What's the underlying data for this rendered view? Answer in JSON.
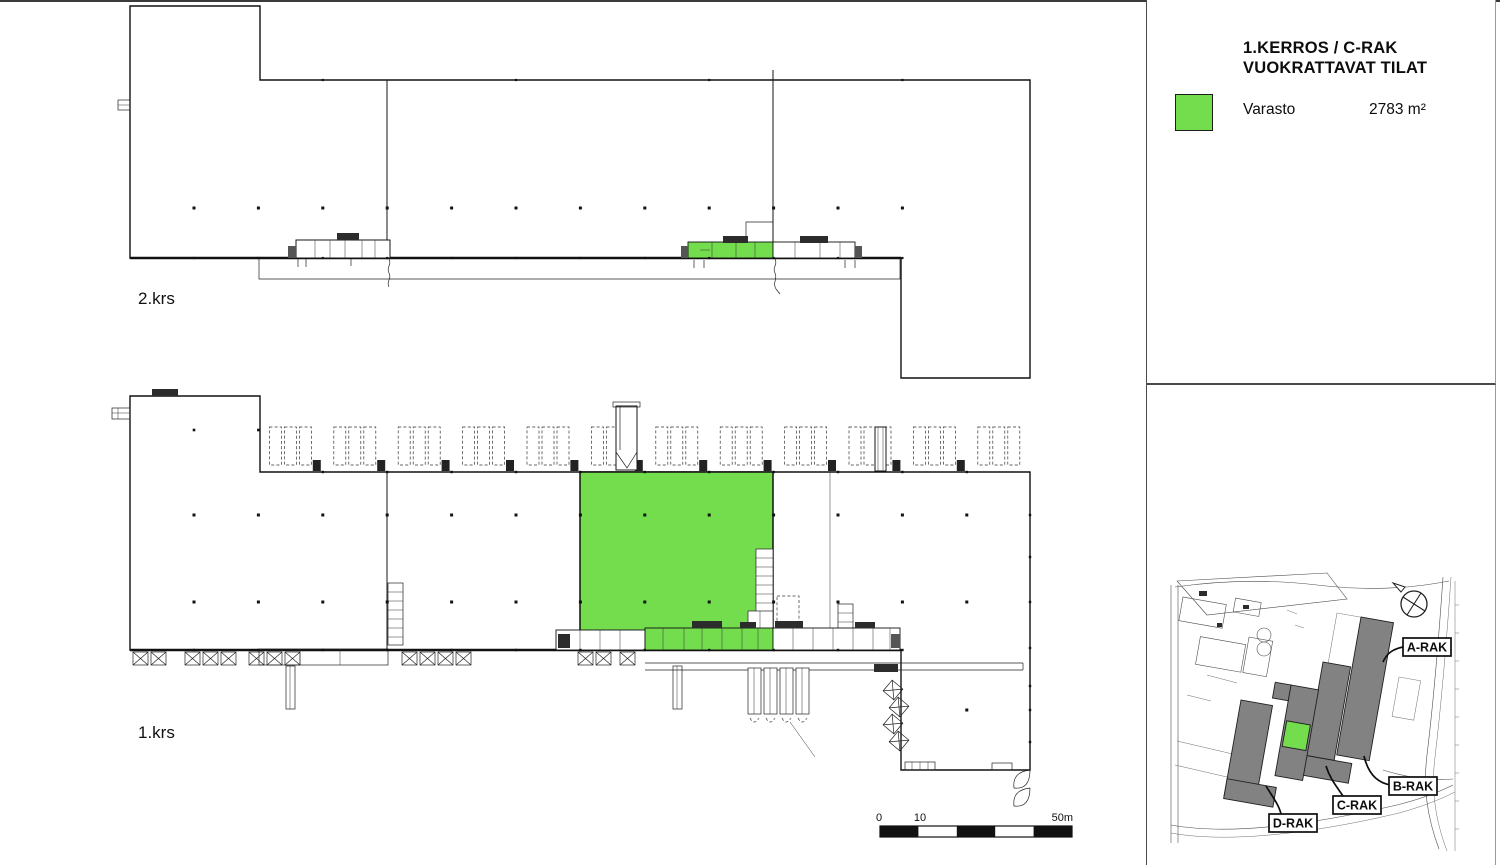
{
  "colors": {
    "highlight_green": "#74DD4E",
    "building_gray": "#828282",
    "line_black": "#111111"
  },
  "legend": {
    "title_line1": "1.KERROS / C-RAK",
    "title_line2": "VUOKRATTAVAT TILAT",
    "items": [
      {
        "swatch": "highlight_green",
        "label": "Varasto",
        "area": "2783 m²"
      }
    ]
  },
  "plans": [
    {
      "id": "2krs",
      "label": "2.krs"
    },
    {
      "id": "1krs",
      "label": "1.krs"
    }
  ],
  "scale_bar": {
    "ticks": [
      "0",
      "10",
      "50m"
    ]
  },
  "site_map": {
    "buildings": [
      {
        "label": "A-RAK"
      },
      {
        "label": "B-RAK"
      },
      {
        "label": "C-RAK"
      },
      {
        "label": "D-RAK"
      }
    ],
    "highlighted_building": "C-RAK"
  }
}
